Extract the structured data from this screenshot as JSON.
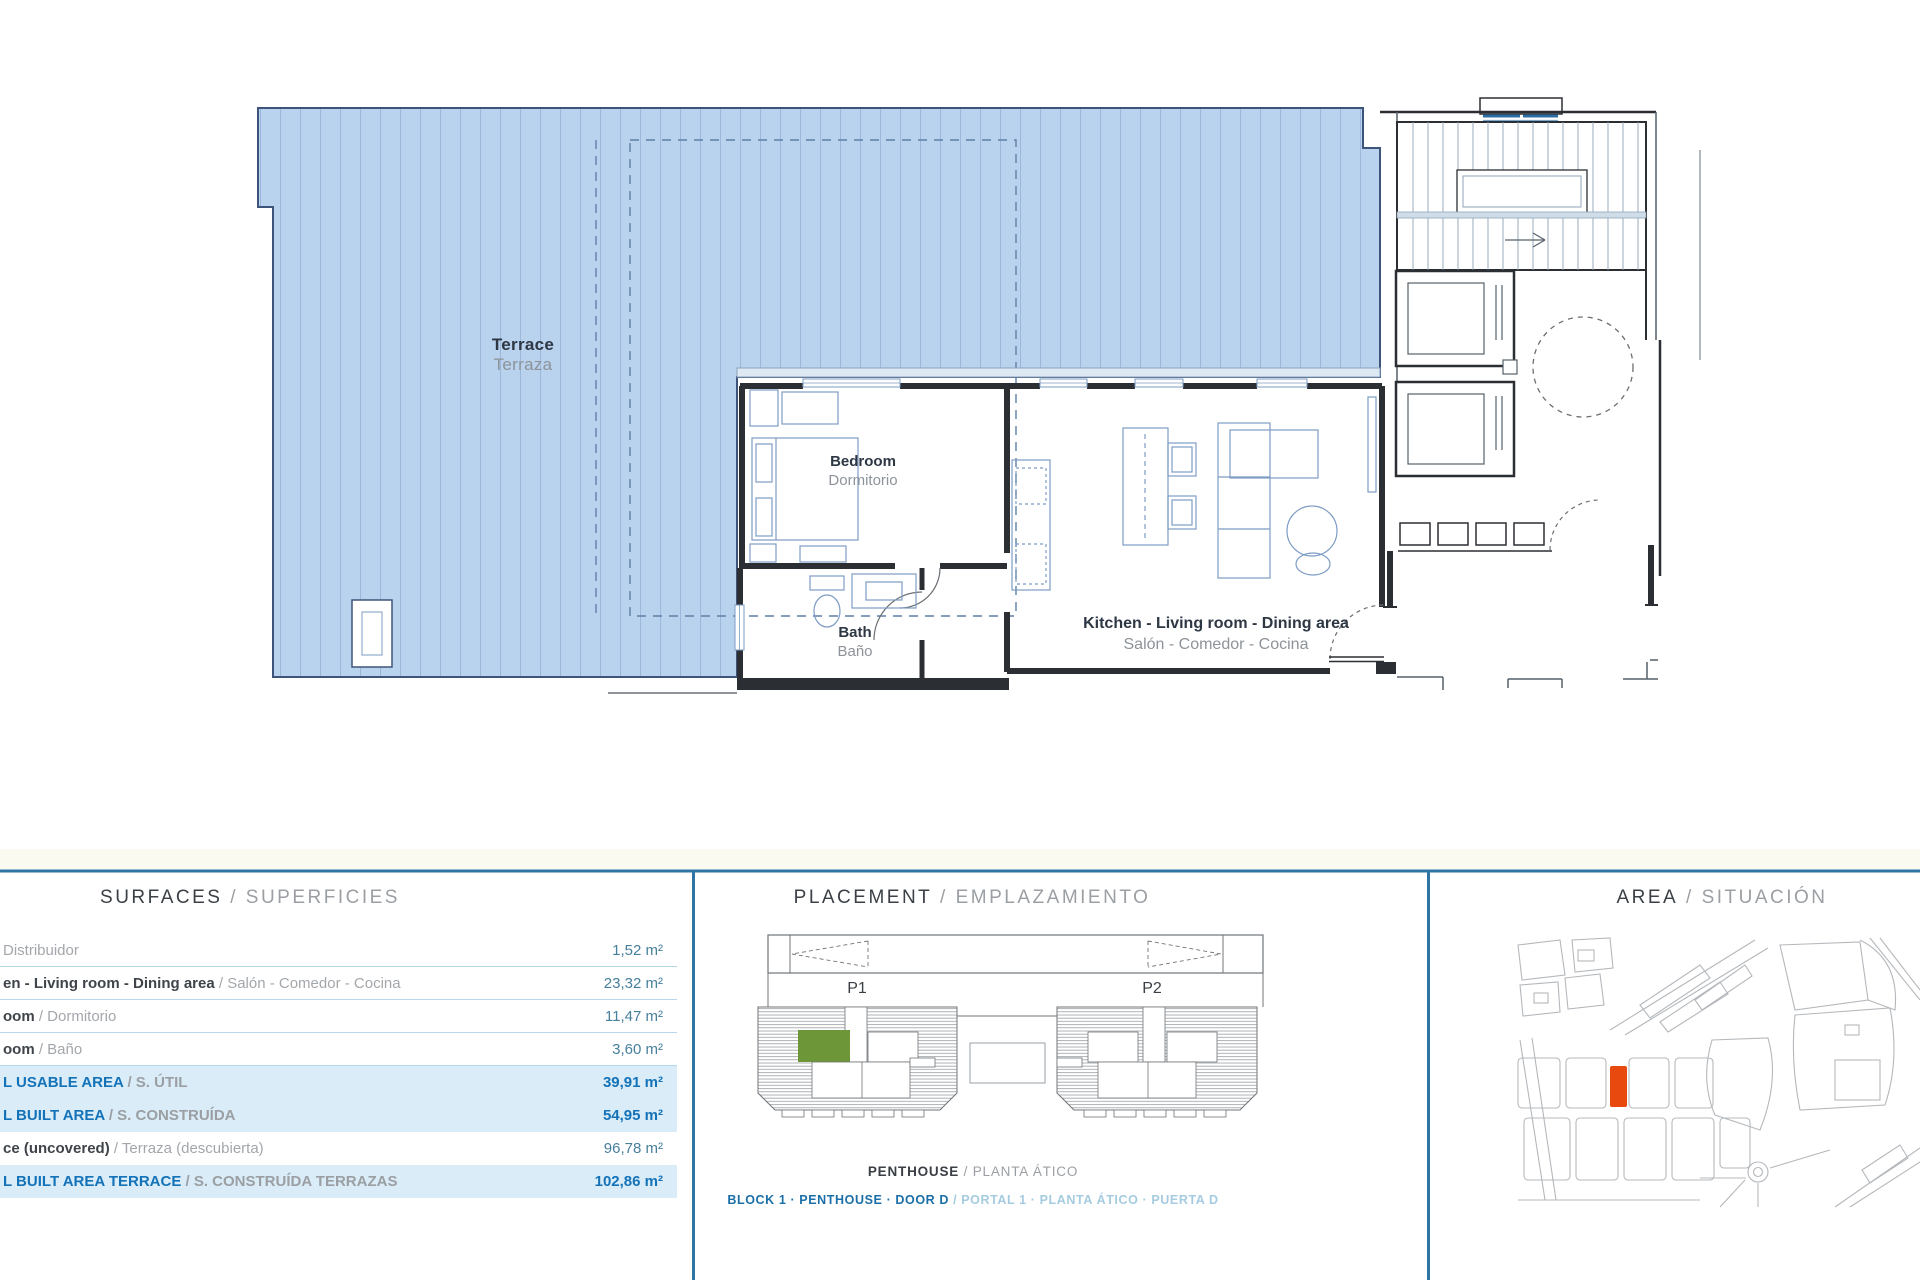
{
  "floorplan": {
    "rooms": {
      "terrace": {
        "en": "Terrace",
        "es": "Terraza"
      },
      "bedroom": {
        "en": "Bedroom",
        "es": "Dormitorio"
      },
      "bath": {
        "en": "Bath",
        "es": "Baño"
      },
      "kitchen": {
        "en": "Kitchen - Living room - Dining area",
        "es": "Salón - Comedor - Cocina"
      }
    }
  },
  "surfaces": {
    "title_en": "SURFACES",
    "title_sep": " / ",
    "title_es": "SUPERFICIES",
    "rows": [
      {
        "en": "",
        "es": "Distribuidor",
        "value": "1,52 m²"
      },
      {
        "en": "en - Living room - Dining area",
        "es": " / Salón - Comedor - Cocina",
        "value": "23,32 m²"
      },
      {
        "en": "oom",
        "es": " / Dormitorio",
        "value": "11,47 m²"
      },
      {
        "en": "oom",
        "es": " / Baño",
        "value": "3,60 m²"
      },
      {
        "en": "L USABLE AREA",
        "es": " / S. ÚTIL",
        "value": "39,91 m²"
      },
      {
        "en": "L BUILT AREA",
        "es": " / S. CONSTRUÍDA",
        "value": "54,95 m²"
      },
      {
        "en": "ce (uncovered)",
        "es": " / Terraza (descubierta)",
        "value": "96,78 m²"
      },
      {
        "en": "L BUILT AREA TERRACE",
        "es": " / S. CONSTRUÍDA TERRAZAS",
        "value": "102,86 m²"
      }
    ]
  },
  "placement": {
    "title_en": "PLACEMENT",
    "title_sep": " / ",
    "title_es": "EMPLAZAMIENTO",
    "portal1": "P1",
    "portal2": "P2",
    "caption1_en": "PENTHOUSE",
    "caption1_sep": " / ",
    "caption1_es": "PLANTA ÁTICO",
    "caption2_en": "BLOCK 1 · PENTHOUSE · DOOR D",
    "caption2_sep": " / ",
    "caption2_es": "PORTAL 1 · PLANTA ÁTICO · PUERTA D"
  },
  "area": {
    "title_en": "AREA",
    "title_sep": " / ",
    "title_es": "SITUACIÓN"
  },
  "colors": {
    "divider": "#2e75a3",
    "row_highlight": "#d9ecf7",
    "total_blue": "#1472b8",
    "value_teal": "#47809c",
    "unit_green": "#6d9638",
    "plot_orange": "#e8490f",
    "terrace_fill": "#b9d2ee",
    "terrace_stripe": "#7d9cc4"
  }
}
